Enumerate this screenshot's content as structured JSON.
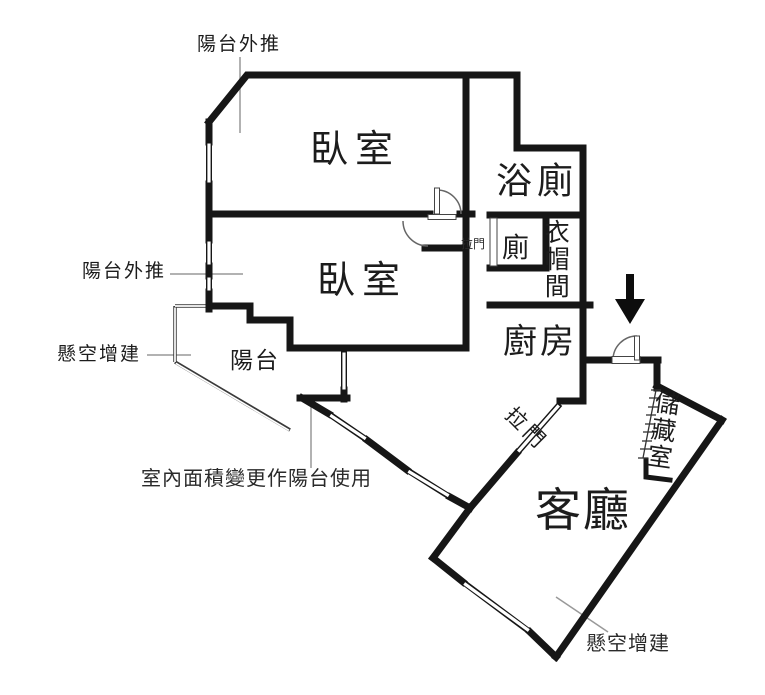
{
  "plan": {
    "rooms": {
      "bedroom1": "臥室",
      "bedroom2": "臥室",
      "bath": "浴廁",
      "toilet": "廁",
      "closet": "衣帽間",
      "kitchen": "廚房",
      "living_room": "客廳",
      "storage": "儲藏室",
      "balcony": "陽台"
    },
    "annotations": {
      "balcony_pushout_top": "陽台外推",
      "balcony_pushout_left": "陽台外推",
      "overhang_left": "懸空增建",
      "overhang_bottom": "懸空增建",
      "area_change_note": "室內面積變更作陽台使用",
      "sliding_door_toilet": "拉門",
      "sliding_door_living": "拉門"
    },
    "icons": {
      "entry_arrow": "down-arrow"
    },
    "colors": {
      "wall": "#161616",
      "leader_line": "#999999",
      "door_arc": "#666666",
      "background": "#ffffff"
    }
  }
}
